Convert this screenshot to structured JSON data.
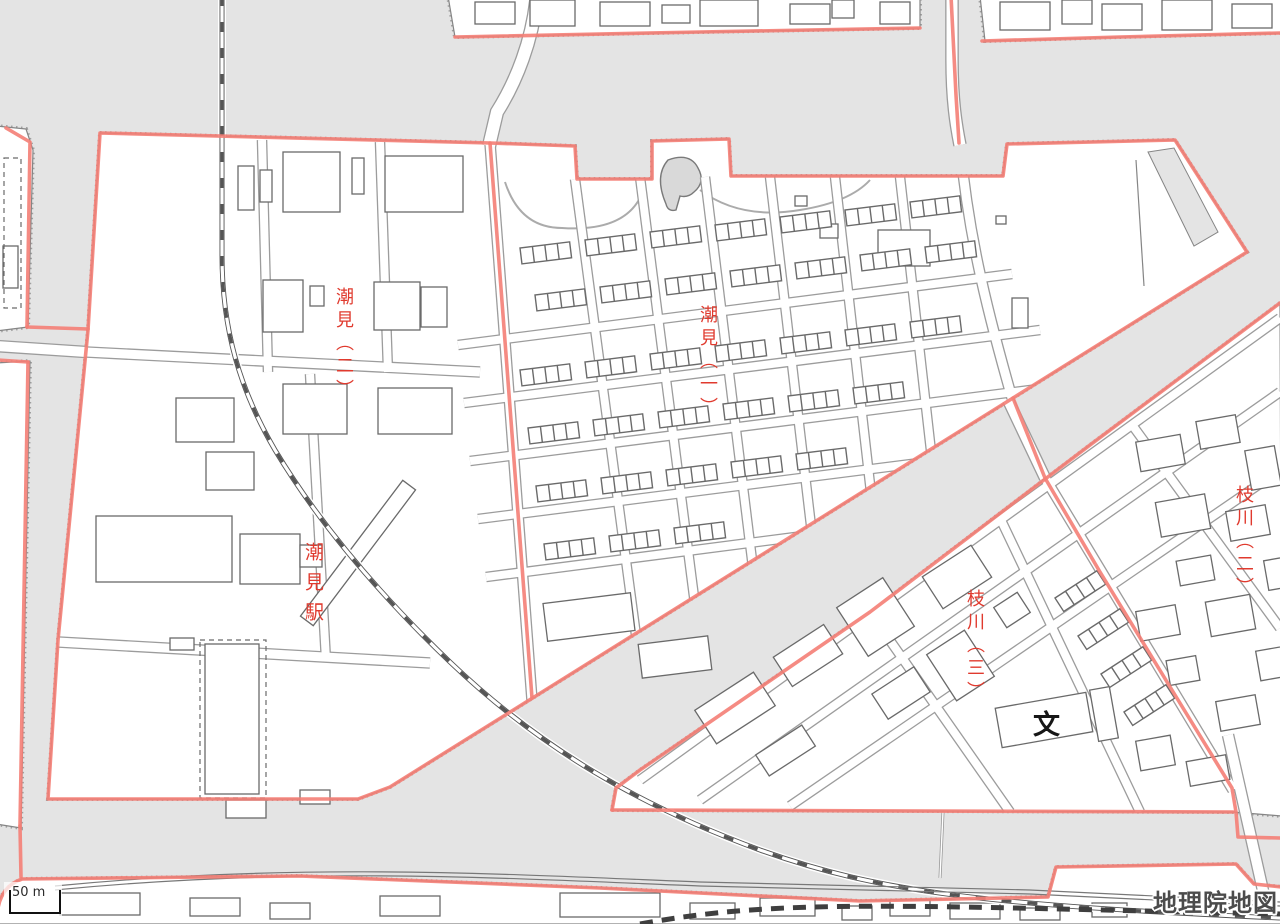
{
  "map": {
    "district_labels": [
      {
        "id": "shiomi-2",
        "text": "潮見（二）"
      },
      {
        "id": "shiomi-1",
        "text": "潮見（一）"
      },
      {
        "id": "edagawa-3",
        "text": "枝川（三）"
      },
      {
        "id": "edagawa-2",
        "text": "枝川（二）"
      }
    ],
    "station_label": {
      "text": "潮見駅"
    },
    "poi": {
      "school_symbol": "文"
    },
    "scale_bar": {
      "label": "50 m"
    },
    "attribution": {
      "text": "地理院地図"
    },
    "colors": {
      "water": "#e4e4e4",
      "land": "#ffffff",
      "district_boundary": "#f47e76",
      "label_red": "#e03a2e",
      "building_outline": "#6a6a6a",
      "coastline": "#858585",
      "road_casing": "#9c9c9c",
      "railway": "#555555",
      "watermark": "#4b4b4b"
    }
  }
}
